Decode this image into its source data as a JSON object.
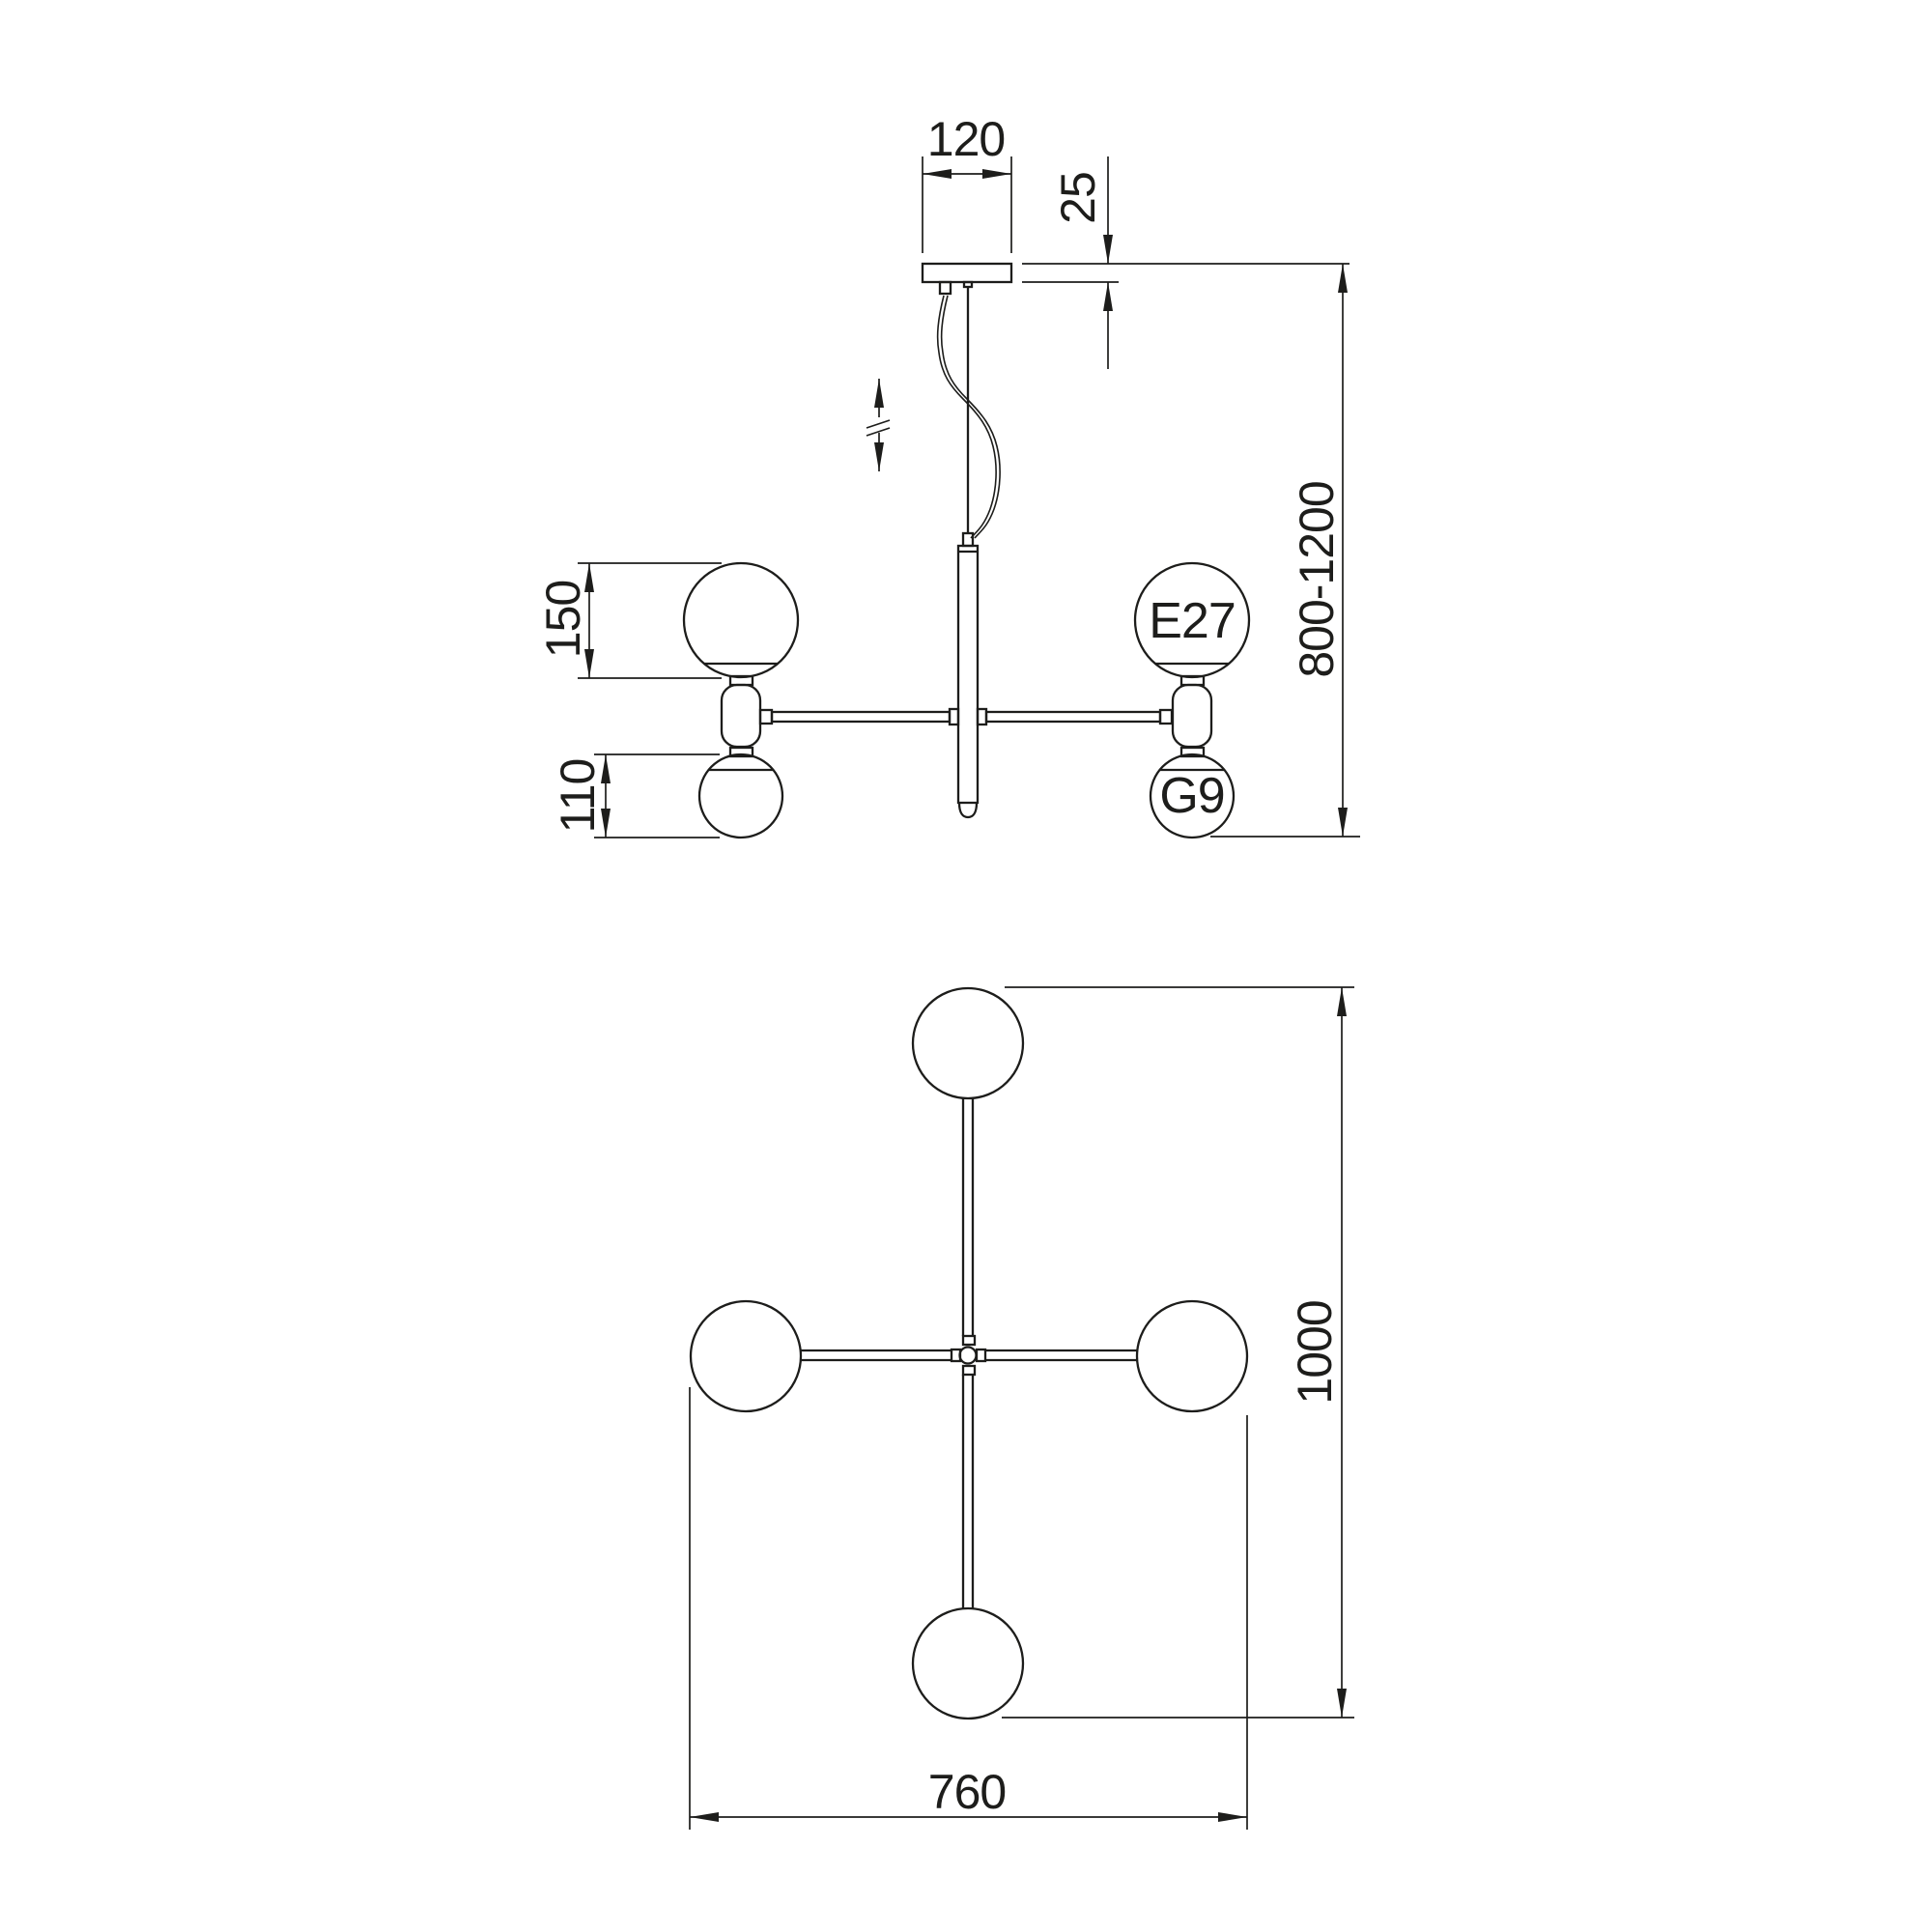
{
  "style": {
    "line_color": "#1d1d1b",
    "background": "#ffffff"
  },
  "front_view": {
    "dimensions": {
      "canopy_width": "120",
      "canopy_thickness": "25",
      "suspension_height_range": "800-1200",
      "large_shade_diameter": "150",
      "small_shade_diameter": "110"
    },
    "socket_labels": {
      "large": "E27",
      "small": "G9"
    }
  },
  "plan_view": {
    "dimensions": {
      "overall_height": "1000",
      "overall_width": "760"
    }
  }
}
